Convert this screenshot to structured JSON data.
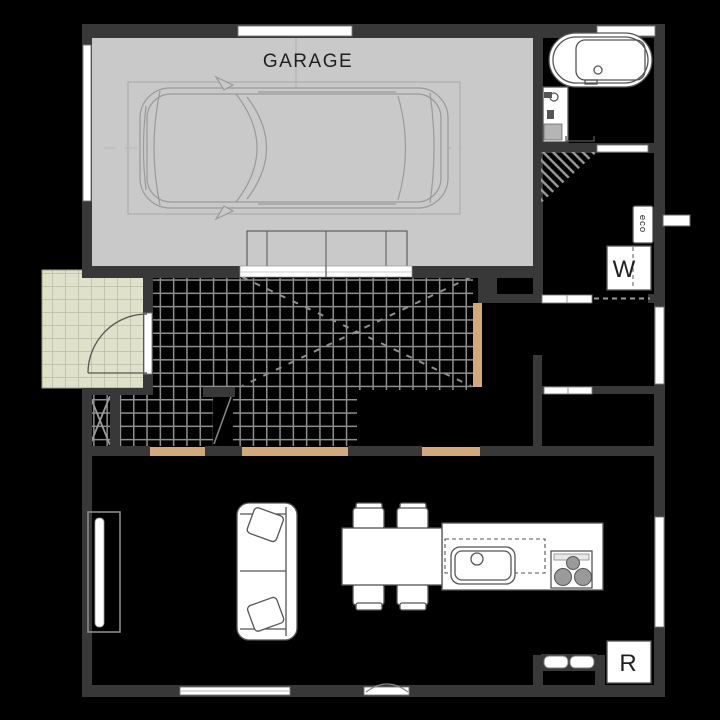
{
  "plan": {
    "labels": {
      "garage": "GARAGE",
      "washer": "W",
      "fridge": "R",
      "water_heater": "eco"
    },
    "colors": {
      "background": "#000000",
      "wall": "#383838",
      "garage_floor": "#c9c9c9",
      "car_line": "#9a9a9a",
      "porch_tile": "#e0e1cb",
      "porch_tile_line": "#b2b39c",
      "hall_tile_line": "#8f8f8f",
      "threshold": "#d2a87c",
      "fixture_fill": "#ffffff",
      "fixture_line": "#555555",
      "label_text": "#1f1f1f"
    }
  }
}
